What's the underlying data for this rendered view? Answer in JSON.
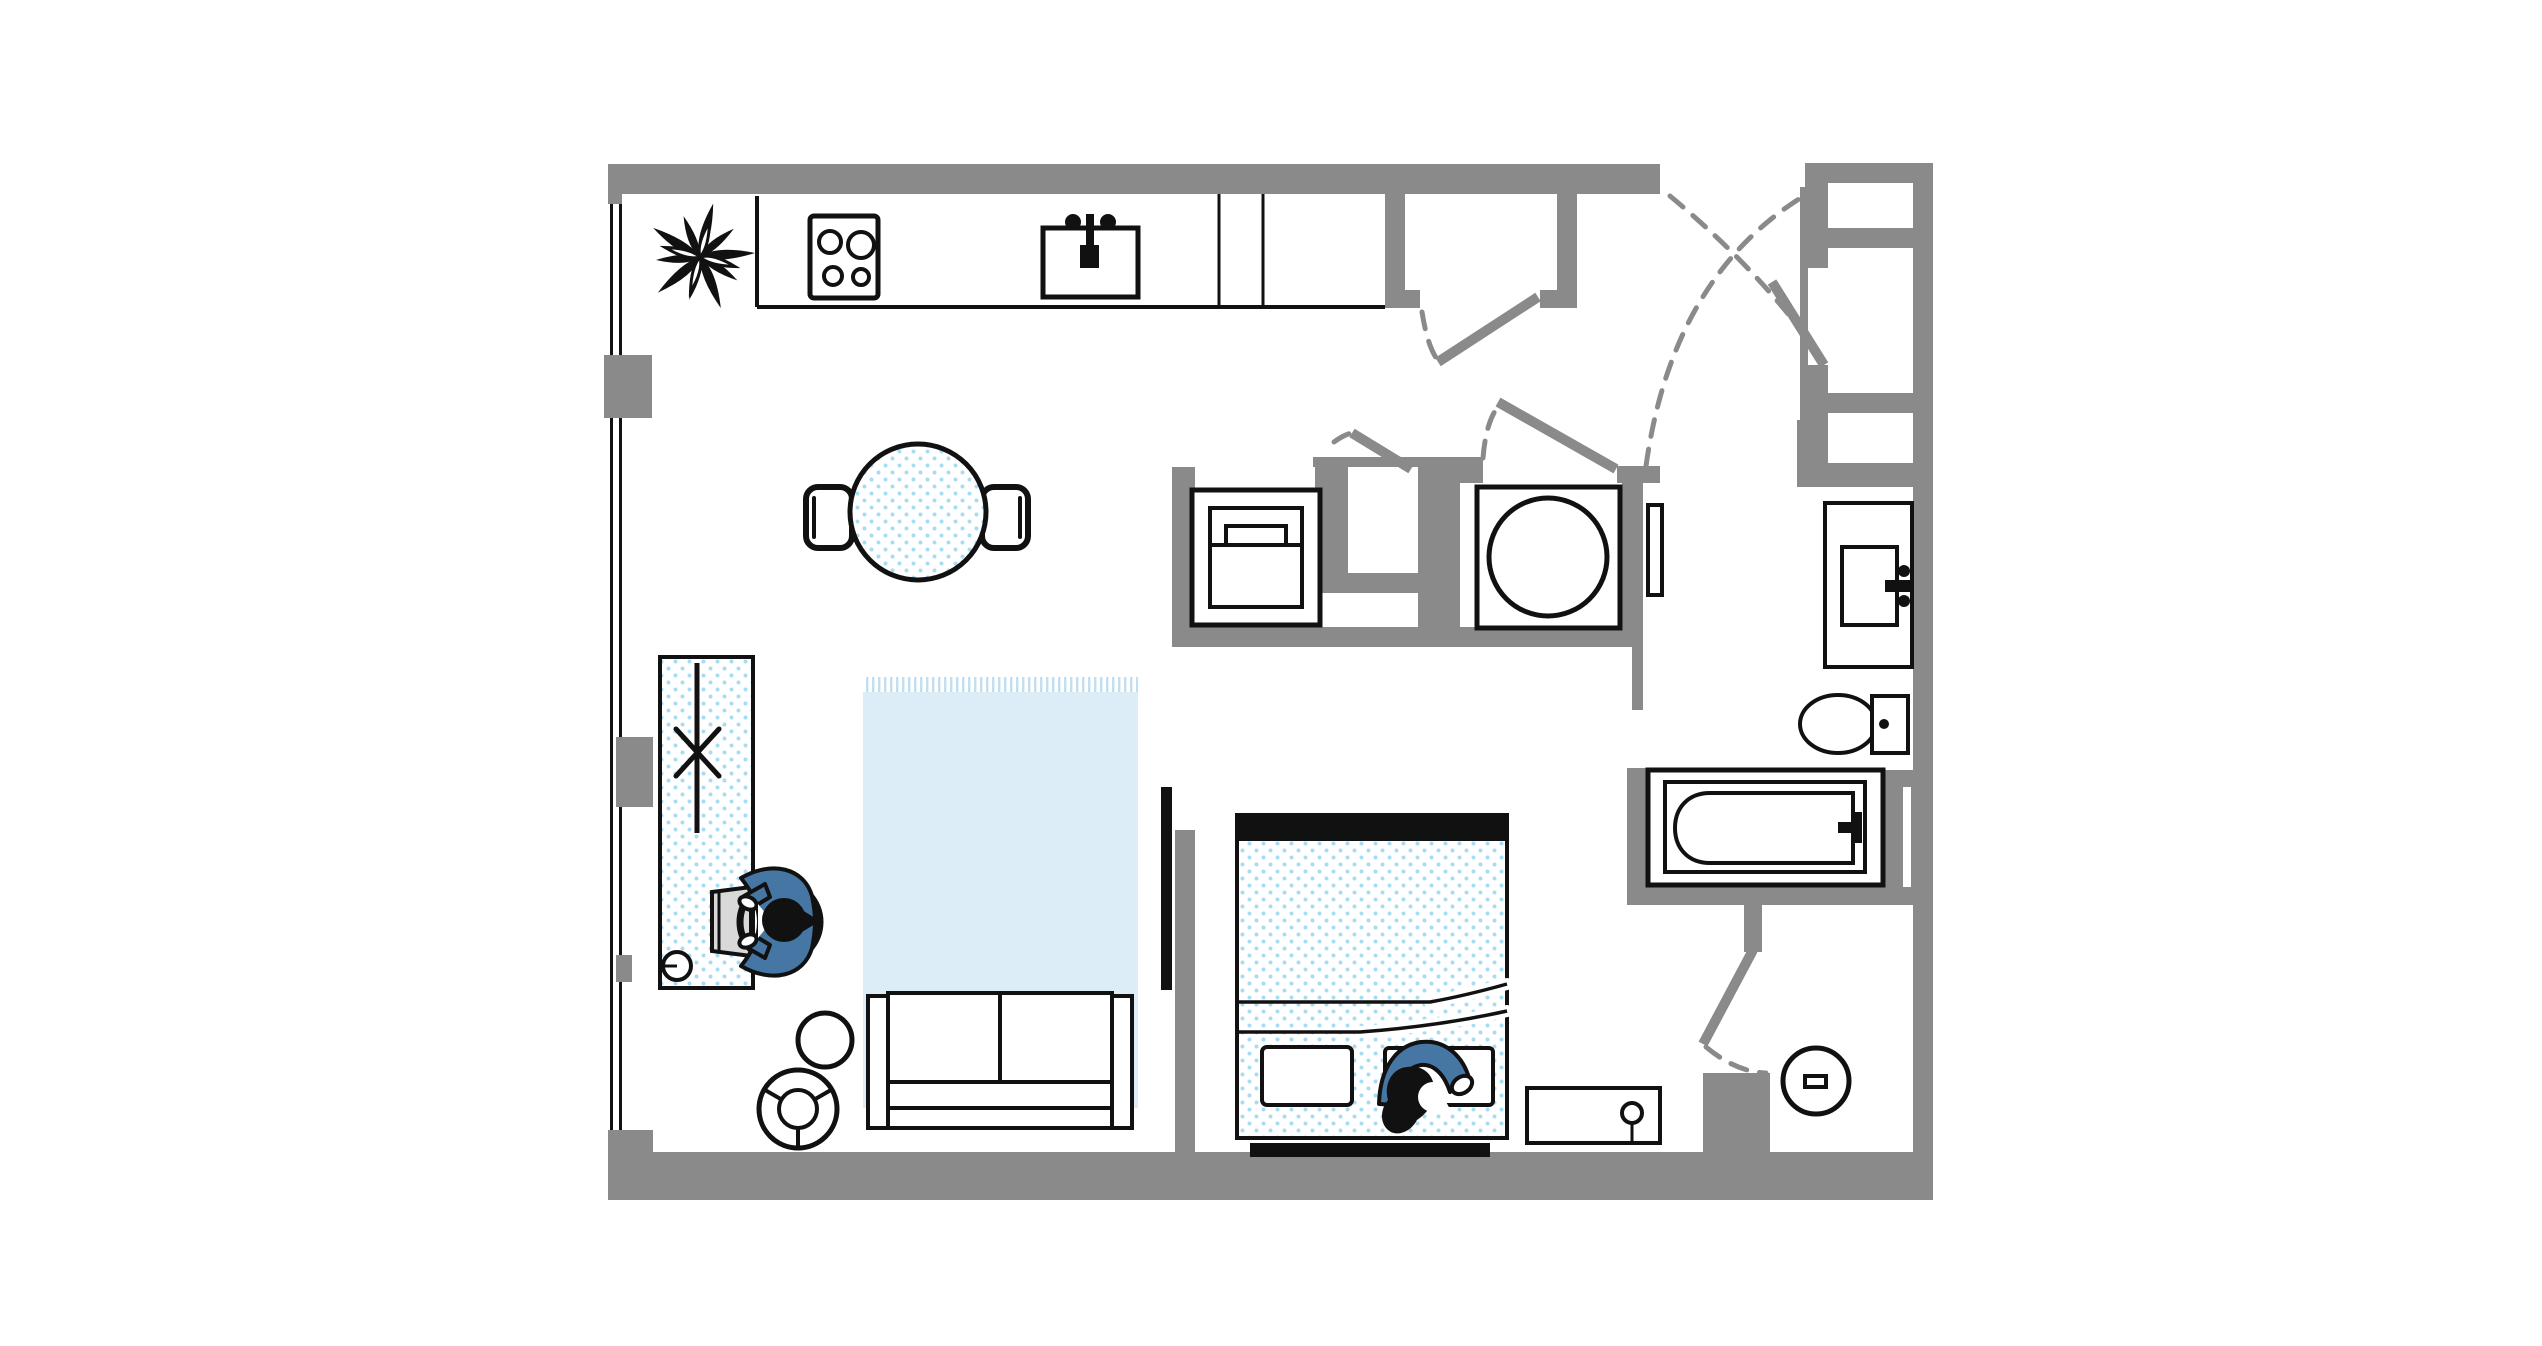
{
  "title": "Studio apartment floor plan",
  "colors": {
    "wall": "#8a8a8a",
    "line": "#111111",
    "dot": "#a9dbf2",
    "rug": "#dcedf8",
    "fringe": "#c2dff0",
    "figure": "#4677a4",
    "laptop": "#d9d9d9",
    "paper": "#ffffff"
  },
  "items": {
    "plant": {
      "label": "Potted plant"
    },
    "counter": {
      "label": "Kitchen counter"
    },
    "stove": {
      "label": "Cooktop with four burners"
    },
    "sink": {
      "label": "Kitchen sink with faucet"
    },
    "dining_table": {
      "label": "Round dining table"
    },
    "chair_left": {
      "label": "Dining chair left"
    },
    "chair_right": {
      "label": "Dining chair right"
    },
    "desk": {
      "label": "Desk with table runner decor"
    },
    "cup": {
      "label": "Cup on desk"
    },
    "laptop": {
      "label": "Laptop"
    },
    "desk_person": {
      "label": "Person working at desk"
    },
    "rug": {
      "label": "Area rug with fringe"
    },
    "sofa": {
      "label": "Two-seat sofa"
    },
    "side_table": {
      "label": "Round side table"
    },
    "pouf": {
      "label": "Round pouf table"
    },
    "tv": {
      "label": "Wall-mounted TV"
    },
    "bed": {
      "label": "Double bed with duvet"
    },
    "bed_person": {
      "label": "Person sleeping in bed"
    },
    "bed_bench": {
      "label": "Headboard bench"
    },
    "nightstand": {
      "label": "Console with lamp"
    },
    "washer": {
      "label": "Top-load washer"
    },
    "dryer": {
      "label": "Dryer with round drum"
    },
    "panel": {
      "label": "Leaning door panel"
    },
    "wardrobe": {
      "label": "Entry wardrobe with shelves"
    },
    "entry_door": {
      "label": "Entry door with swing arcs"
    },
    "closet_door": {
      "label": "Hall closet door"
    },
    "utility_door": {
      "label": "Utility closet door"
    },
    "bedroom_door": {
      "label": "Bedroom door"
    },
    "wc_door": {
      "label": "Shower room door"
    },
    "vanity": {
      "label": "Bathroom vanity sink"
    },
    "toilet": {
      "label": "Toilet"
    },
    "bathtub": {
      "label": "Bathtub with faucet"
    },
    "drain": {
      "label": "Round floor drain"
    },
    "windows": {
      "label": "Window wall"
    }
  }
}
